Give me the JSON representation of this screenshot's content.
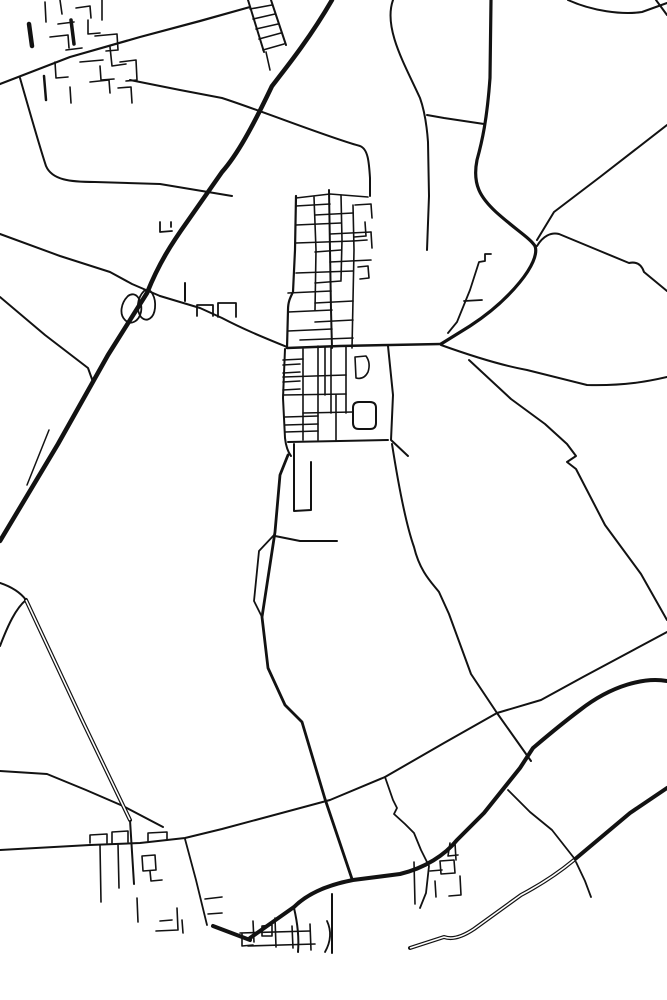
{
  "map": {
    "kind": "monochrome-road-line-map",
    "background": "#ffffff",
    "stroke": "#121212",
    "casing_fill": "#ffffff",
    "width": 667,
    "height": 1000,
    "roads": [
      {
        "name": "motorway",
        "d": "M332,0 C310,38 286,68 272,86 C252,128 237,155 222,172 L187,222 C172,243 159,263 147,293 L108,355 L58,444 L0,541",
        "w": 4.5
      },
      {
        "name": "motorway-side-stub",
        "d": "M49,430 L27,485",
        "w": 1.5
      },
      {
        "name": "northeast-main-road",
        "d": "M491,0 L490,78 C487,120 482,142 477,160 C472,185 481,198 496,212 C516,230 530,238 535,246 C541,262 510,300 470,326 L441,344",
        "w": 3.2
      },
      {
        "name": "top-right-curve",
        "d": "M568,0 C592,11 622,15 642,12 L667,3",
        "w": 2
      },
      {
        "name": "top-right-corner-stub",
        "d": "M656,0 L667,15",
        "w": 2
      },
      {
        "name": "northeast-diagonal",
        "d": "M667,125 L600,177 L554,212 L537,240",
        "w": 2
      },
      {
        "name": "east-bumpy-road",
        "d": "M537,246 C543,236 551,232 559,234 L600,251 L629,263 C638,261 642,266 644,272 L667,291",
        "w": 2
      },
      {
        "name": "east-field-curve",
        "d": "M441,345 C480,359 505,366 527,370 L587,385 C625,386 650,381 667,377",
        "w": 2
      },
      {
        "name": "southeast-zigzag-road",
        "d": "M469,360 L511,399 L545,424 L567,444 L576,456 L567,462 L576,469 L605,525 L641,574 L667,620",
        "w": 2
      },
      {
        "name": "long-southern-diagonal",
        "d": "M667,632 L583,677 L541,700 L497,713 L444,743 L385,777 L330,800 L222,829 L185,838 L140,843 L90,845 L0,850",
        "w": 2
      },
      {
        "name": "mid-north-south-road",
        "d": "M392,444 C400,495 408,530 414,547 C420,572 432,583 439,592 L449,614 L471,674 L497,713 L531,761",
        "w": 2
      },
      {
        "name": "southeast-thick-road",
        "d": "M667,681 C645,677 612,685 580,710 C560,725 546,737 533,748 L520,768 L484,813 L457,840 C445,855 425,868 400,874 L353,880 C322,886 305,896 294,907 L250,938",
        "w": 4
      },
      {
        "name": "village-thick-spur",
        "d": "M213,926 L250,940",
        "w": 4
      },
      {
        "name": "central-south-road",
        "d": "M288,455 L280,475 L275,532 L262,617 L268,668 L285,705 L302,722 L325,799 L352,879",
        "w": 2.8
      },
      {
        "name": "lens-branch",
        "d": "M275,534 L259,551 L254,601 L262,617",
        "w": 1.8
      },
      {
        "name": "east-stub-road",
        "d": "M275,536 L300,541 L337,541",
        "w": 2
      },
      {
        "name": "loop-street",
        "d": "M294,444 L294,511 L311,510 L311,462",
        "w": 2
      },
      {
        "name": "northwest-field-road",
        "d": "M20,78 C32,120 40,148 46,166 C52,180 70,182 95,182 L160,184 L232,196",
        "w": 2
      },
      {
        "name": "long-top-diagonal",
        "d": "M0,84 L70,57 L140,37 L200,21 L250,7",
        "w": 2.2
      },
      {
        "name": "upper-field-road",
        "d": "M130,80 L180,90 L222,98 C265,112 330,138 360,146 C368,149 369,162 370,178 L370,196",
        "w": 2
      },
      {
        "name": "north-approach-road",
        "d": "M393,0 C383,28 405,65 420,98 C425,112 427,128 428,142 L429,196 L427,250",
        "w": 2
      },
      {
        "name": "north-link-road",
        "d": "M427,115 L444,118 L484,124",
        "w": 2
      },
      {
        "name": "nw-interchange-approach",
        "d": "M0,234 L60,256 L110,272 L132,284 L160,296",
        "w": 2
      },
      {
        "name": "village-west-approach",
        "d": "M160,296 L200,308 L222,318 C245,330 265,338 287,347",
        "w": 2
      },
      {
        "name": "west-field-road",
        "d": "M0,297 L45,335 L88,368 L93,382",
        "w": 2
      },
      {
        "name": "interchange-loop-west",
        "d": "M128,296 C121,303 119,314 125,320 C131,326 139,321 141,312 C143,301 136,290 128,296 Z",
        "w": 1.8
      },
      {
        "name": "interchange-loop-east",
        "d": "M144,291 C137,298 136,310 141,317 C147,323 154,318 155,308 C156,298 151,286 144,291 Z",
        "w": 1.8
      },
      {
        "name": "interchange-north-stub",
        "d": "M185,283 L185,301",
        "w": 2
      },
      {
        "name": "north-stub-street-a",
        "d": "M160,222 L160,232 L172,231",
        "w": 1.8
      },
      {
        "name": "north-stub-street-b",
        "d": "M171,222 L171,227",
        "w": 1.8
      },
      {
        "name": "roadside-block-a",
        "d": "M197,316 L197,305 L213,305 L213,316",
        "w": 1.8
      },
      {
        "name": "roadside-block-b",
        "d": "M218,317 L218,303 L236,303 L236,317",
        "w": 1.8
      },
      {
        "name": "ladder-rail-west",
        "d": "M248,0 L264,52",
        "w": 2
      },
      {
        "name": "ladder-rail-east",
        "d": "M271,0 L286,45",
        "w": 2
      },
      {
        "name": "ladder-rung-1",
        "d": "M250,9 L272,5",
        "w": 1.6
      },
      {
        "name": "ladder-rung-2",
        "d": "M253,19 L275,14",
        "w": 1.6
      },
      {
        "name": "ladder-rung-3",
        "d": "M256,29 L278,24",
        "w": 1.6
      },
      {
        "name": "ladder-rung-4",
        "d": "M259,39 L281,33",
        "w": 1.6
      },
      {
        "name": "ladder-rung-5",
        "d": "M263,50 L284,44",
        "w": 1.6
      },
      {
        "name": "ladder-south-stub",
        "d": "M266,52 L270,70",
        "w": 1.6
      },
      {
        "name": "nw-village-street-1",
        "d": "M102,0 L102,20",
        "w": 1.6
      },
      {
        "name": "nw-village-street-2",
        "d": "M60,0 L62,14",
        "w": 1.6
      },
      {
        "name": "nw-village-street-3",
        "d": "M45,2 L46,22",
        "w": 1.6
      },
      {
        "name": "nw-village-street-4",
        "d": "M76,8 L90,6 L91,18",
        "w": 1.6
      },
      {
        "name": "nw-village-street-5",
        "d": "M58,24 L74,22",
        "w": 1.6
      },
      {
        "name": "nw-village-street-6",
        "d": "M88,20 L88,34 L100,33",
        "w": 1.6
      },
      {
        "name": "nw-village-street-7",
        "d": "M50,37 L68,35 L69,48",
        "w": 1.6
      },
      {
        "name": "nw-village-street-8",
        "d": "M95,36 L117,34 L118,50 L106,51",
        "w": 1.6
      },
      {
        "name": "nw-village-street-9",
        "d": "M66,50 L82,48",
        "w": 1.6
      },
      {
        "name": "nw-village-street-10",
        "d": "M110,47 L112,66 L126,64",
        "w": 1.6
      },
      {
        "name": "nw-village-street-11",
        "d": "M80,62 L103,60",
        "w": 1.6
      },
      {
        "name": "nw-village-street-12",
        "d": "M100,66 L101,80 L114,79",
        "w": 1.6
      },
      {
        "name": "nw-village-street-13",
        "d": "M55,62 L56,78 L68,77",
        "w": 1.6
      },
      {
        "name": "nw-village-street-14",
        "d": "M120,62 L136,60 L137,80 L126,81",
        "w": 1.6
      },
      {
        "name": "nw-village-street-15",
        "d": "M90,82 L109,80 L110,93",
        "w": 1.6
      },
      {
        "name": "nw-village-street-16",
        "d": "M70,87 L71,103",
        "w": 1.6
      },
      {
        "name": "nw-village-street-17",
        "d": "M118,88 L131,87 L132,103",
        "w": 1.6
      },
      {
        "name": "nw-village-bold-bar",
        "d": "M29,24 L32,46",
        "w": 4.5
      },
      {
        "name": "nw-village-bold-bar-2",
        "d": "M71,20 L74,44",
        "w": 3.5
      },
      {
        "name": "nw-village-south-stub",
        "d": "M44,76 L46,100",
        "w": 2.5
      },
      {
        "name": "village-north-west-boundary",
        "d": "M296,196 L295,250 L293,292 C290,298 288,302 288,310 L287,348",
        "w": 2.2
      },
      {
        "name": "village-north-inner-west",
        "d": "M314,197 L316,250 L315,310",
        "w": 1.6
      },
      {
        "name": "village-main-street",
        "d": "M329,190 L330,250 L331,310 L332,348",
        "w": 2
      },
      {
        "name": "village-north-inner-east",
        "d": "M341,195 L342,240 L341,280",
        "w": 1.6
      },
      {
        "name": "village-north-east-street",
        "d": "M353,205 L354,250 L353,300 L352,348",
        "w": 1.6
      },
      {
        "name": "village-north-top-street",
        "d": "M296,198 L330,194 L368,197",
        "w": 1.6
      },
      {
        "name": "village-rung-1",
        "d": "M296,206 L330,204",
        "w": 1.6
      },
      {
        "name": "village-rung-2",
        "d": "M315,215 L353,213",
        "w": 1.6
      },
      {
        "name": "village-rung-3",
        "d": "M296,225 L341,223",
        "w": 1.6
      },
      {
        "name": "village-rung-4",
        "d": "M330,234 L371,232",
        "w": 1.6
      },
      {
        "name": "village-rung-5",
        "d": "M296,243 L353,241",
        "w": 1.6
      },
      {
        "name": "village-rung-6",
        "d": "M315,252 L341,250",
        "w": 1.6
      },
      {
        "name": "village-rung-7",
        "d": "M330,262 L371,260",
        "w": 1.6
      },
      {
        "name": "village-rung-8",
        "d": "M296,273 L353,271",
        "w": 1.6
      },
      {
        "name": "village-rung-9",
        "d": "M315,283 L341,281",
        "w": 1.6
      },
      {
        "name": "village-rung-10",
        "d": "M288,293 L331,291",
        "w": 1.6
      },
      {
        "name": "village-rung-11",
        "d": "M315,303 L353,301",
        "w": 1.6
      },
      {
        "name": "village-rung-12",
        "d": "M288,312 L332,310",
        "w": 1.6
      },
      {
        "name": "village-rung-13",
        "d": "M315,322 L353,320",
        "w": 1.6
      },
      {
        "name": "village-rung-14",
        "d": "M288,331 L332,329",
        "w": 1.6
      },
      {
        "name": "village-rung-15",
        "d": "M300,340 L353,338",
        "w": 1.6
      },
      {
        "name": "village-ne-stub-1",
        "d": "M355,205 L371,204 L372,218",
        "w": 1.6
      },
      {
        "name": "village-ne-stub-2",
        "d": "M365,222 L366,236 L354,237",
        "w": 1.6
      },
      {
        "name": "village-ne-stub-3",
        "d": "M371,232 L372,248",
        "w": 1.6
      },
      {
        "name": "village-ne-hook",
        "d": "M358,267 L368,266 L369,278 L360,279",
        "w": 1.6
      },
      {
        "name": "village-ne-stub-4",
        "d": "M353,241 L367,240",
        "w": 1.6
      },
      {
        "name": "ne-step-road",
        "d": "M491,254 L485,254 L485,261 L479,262 L470,290 L457,322 L448,333",
        "w": 1.8
      },
      {
        "name": "ne-crossbar",
        "d": "M464,301 L482,300",
        "w": 1.8
      },
      {
        "name": "village-main-crossroad",
        "d": "M287,348 L340,346 L390,345 L441,344",
        "w": 2.5
      },
      {
        "name": "village-south-west-boundary",
        "d": "M285,349 L283,398 L285,438 C286,447 288,452 291,456",
        "w": 2
      },
      {
        "name": "village-south-boundary",
        "d": "M288,442 L340,441 L388,440",
        "w": 2
      },
      {
        "name": "village-south-east-boundary",
        "d": "M388,346 L393,395 L391,440 L408,456",
        "w": 2
      },
      {
        "name": "rounded-block",
        "d": "M359,402 L370,402 Q376,402 376,408 L376,423 Q376,429 370,429 L359,429 Q353,429 353,423 L353,408 Q353,402 359,402 Z",
        "w": 2
      },
      {
        "name": "rounded-block-small",
        "d": "M355,357 L366,356 Q371,363 368,372 Q364,380 356,378 Z",
        "w": 1.6
      },
      {
        "name": "village-south-v1",
        "d": "M303,349 L303,440",
        "w": 1.6
      },
      {
        "name": "village-south-v2",
        "d": "M318,346 L318,440",
        "w": 1.6
      },
      {
        "name": "village-south-v3",
        "d": "M325,347 L325,395",
        "w": 1.6
      },
      {
        "name": "village-south-v4",
        "d": "M331,346 L331,413",
        "w": 1.6
      },
      {
        "name": "village-south-v5",
        "d": "M336,395 L336,440",
        "w": 1.6
      },
      {
        "name": "village-south-v6",
        "d": "M346,346 L346,413",
        "w": 1.6
      },
      {
        "name": "village-south-h1",
        "d": "M283,360 L303,359",
        "w": 1.6
      },
      {
        "name": "village-south-h2",
        "d": "M283,377 L346,375",
        "w": 1.6
      },
      {
        "name": "village-south-h3",
        "d": "M283,395 L346,394",
        "w": 1.6
      },
      {
        "name": "village-south-h4",
        "d": "M303,413 L353,412",
        "w": 1.6
      },
      {
        "name": "village-south-h5",
        "d": "M285,432 L318,431",
        "w": 1.6
      },
      {
        "name": "village-comb-1",
        "d": "M283,365 L300,364",
        "w": 1.6
      },
      {
        "name": "village-comb-2",
        "d": "M283,373 L300,372",
        "w": 1.6
      },
      {
        "name": "village-comb-3",
        "d": "M283,382 L300,381",
        "w": 1.6
      },
      {
        "name": "village-comb-4",
        "d": "M283,390 L300,389",
        "w": 1.6
      },
      {
        "name": "village-comb-5",
        "d": "M285,417 L318,416",
        "w": 1.6
      },
      {
        "name": "village-comb-6",
        "d": "M285,425 L318,424",
        "w": 1.6
      },
      {
        "name": "west-village-road-upper",
        "d": "M0,771 L47,774 L86,790 L123,806 L163,827",
        "w": 2
      },
      {
        "name": "sw-village-bump-1",
        "d": "M90,843 L90,835 L107,834 L107,843",
        "w": 1.6
      },
      {
        "name": "sw-village-bump-2",
        "d": "M112,843 L112,832 L128,831 L128,842",
        "w": 1.6
      },
      {
        "name": "sw-village-rect",
        "d": "M148,841 L148,833 L167,832 L167,840",
        "w": 1.6
      },
      {
        "name": "sw-village-v1",
        "d": "M100,845 L101,902",
        "w": 1.6
      },
      {
        "name": "sw-village-v2",
        "d": "M118,844 L119,888",
        "w": 1.6
      },
      {
        "name": "sw-village-square",
        "d": "M142,856 L155,855 L156,870 L143,871 Z",
        "w": 1.6
      },
      {
        "name": "sw-village-hook",
        "d": "M150,871 L151,881 L162,880",
        "w": 1.6
      },
      {
        "name": "sw-village-v3",
        "d": "M137,898 L138,922",
        "w": 1.6
      },
      {
        "name": "sw-village-diagonal-street",
        "d": "M185,839 L196,880 L207,925",
        "w": 1.8
      },
      {
        "name": "sw-village-stub-1",
        "d": "M205,899 L222,897",
        "w": 1.6
      },
      {
        "name": "sw-village-stub-2",
        "d": "M208,914 L222,913",
        "w": 1.6
      },
      {
        "name": "sw-village-l-hook",
        "d": "M177,908 L178,930 L156,931",
        "w": 1.6
      },
      {
        "name": "sw-village-frag-1",
        "d": "M182,920 L183,933",
        "w": 1.6
      },
      {
        "name": "sw-village-frag-2",
        "d": "M160,921 L172,920",
        "w": 1.6
      },
      {
        "name": "south-village-v1",
        "d": "M253,921 L254,942",
        "w": 1.6
      },
      {
        "name": "south-village-v2",
        "d": "M275,918 L276,947",
        "w": 1.6
      },
      {
        "name": "south-village-v3",
        "d": "M292,926 L293,948",
        "w": 1.6
      },
      {
        "name": "south-village-v4",
        "d": "M310,924 L311,950",
        "w": 1.6
      },
      {
        "name": "south-village-h1",
        "d": "M240,933 L310,931",
        "w": 1.6
      },
      {
        "name": "south-village-h2",
        "d": "M248,946 L315,944",
        "w": 1.6
      },
      {
        "name": "south-village-hook",
        "d": "M242,934 L242,946 L253,945",
        "w": 1.6
      },
      {
        "name": "south-village-curve",
        "d": "M327,921 Q334,936 325,952",
        "w": 1.8
      },
      {
        "name": "south-village-link-east",
        "d": "M332,894 L332,953",
        "w": 2
      },
      {
        "name": "south-village-link-west",
        "d": "M294,908 C298,925 299,940 298,952",
        "w": 2
      },
      {
        "name": "south-village-square",
        "d": "M262,926 L272,925 L272,936 L262,936 Z",
        "w": 1.6
      },
      {
        "name": "se-village-access",
        "d": "M385,777 L393,800 L397,808 L394,814 L405,824 L414,833 L421,850 L429,866 L426,893 L420,908",
        "w": 1.8
      },
      {
        "name": "se-village-square",
        "d": "M440,861 L454,860 L455,873 L441,874 Z",
        "w": 1.6
      },
      {
        "name": "se-village-hook",
        "d": "M450,843 L448,856 L458,855 M455,843 L456,860",
        "w": 1.6
      },
      {
        "name": "se-village-v1",
        "d": "M414,862 L415,904",
        "w": 1.6
      },
      {
        "name": "se-village-h1",
        "d": "M430,871 L442,870",
        "w": 1.6
      },
      {
        "name": "se-village-v2",
        "d": "M435,881 L436,897",
        "w": 1.6
      },
      {
        "name": "se-village-hook-2",
        "d": "M460,876 L461,895 L449,896",
        "w": 1.6
      },
      {
        "name": "connector-between-thick-roads",
        "d": "M508,790 L530,812 L552,830 L574,858",
        "w": 1.8
      },
      {
        "name": "south-stub-past-main",
        "d": "M576,862 L585,881 L591,897",
        "w": 1.8
      },
      {
        "name": "sw-fork-upper",
        "d": "M0,583 C12,587 20,592 26,600",
        "w": 2
      },
      {
        "name": "sw-fork-lower",
        "d": "M0,646 C8,625 16,608 26,600",
        "w": 2
      },
      {
        "name": "sw-road-tail",
        "d": "M130,820 L134,884",
        "w": 2
      },
      {
        "name": "south-main-road",
        "d": "M667,788 L630,813 L574,860",
        "w": 4
      },
      {
        "name": "southwest-cased-road",
        "d": "M26,600 L83,722 L130,820",
        "w": 4,
        "casing": true
      },
      {
        "name": "south-main-road-cased",
        "d": "M574,860 C556,875 538,886 521,895 L474,929 C462,937 452,940 444,937 L410,948",
        "w": 4,
        "casing": true
      }
    ]
  }
}
